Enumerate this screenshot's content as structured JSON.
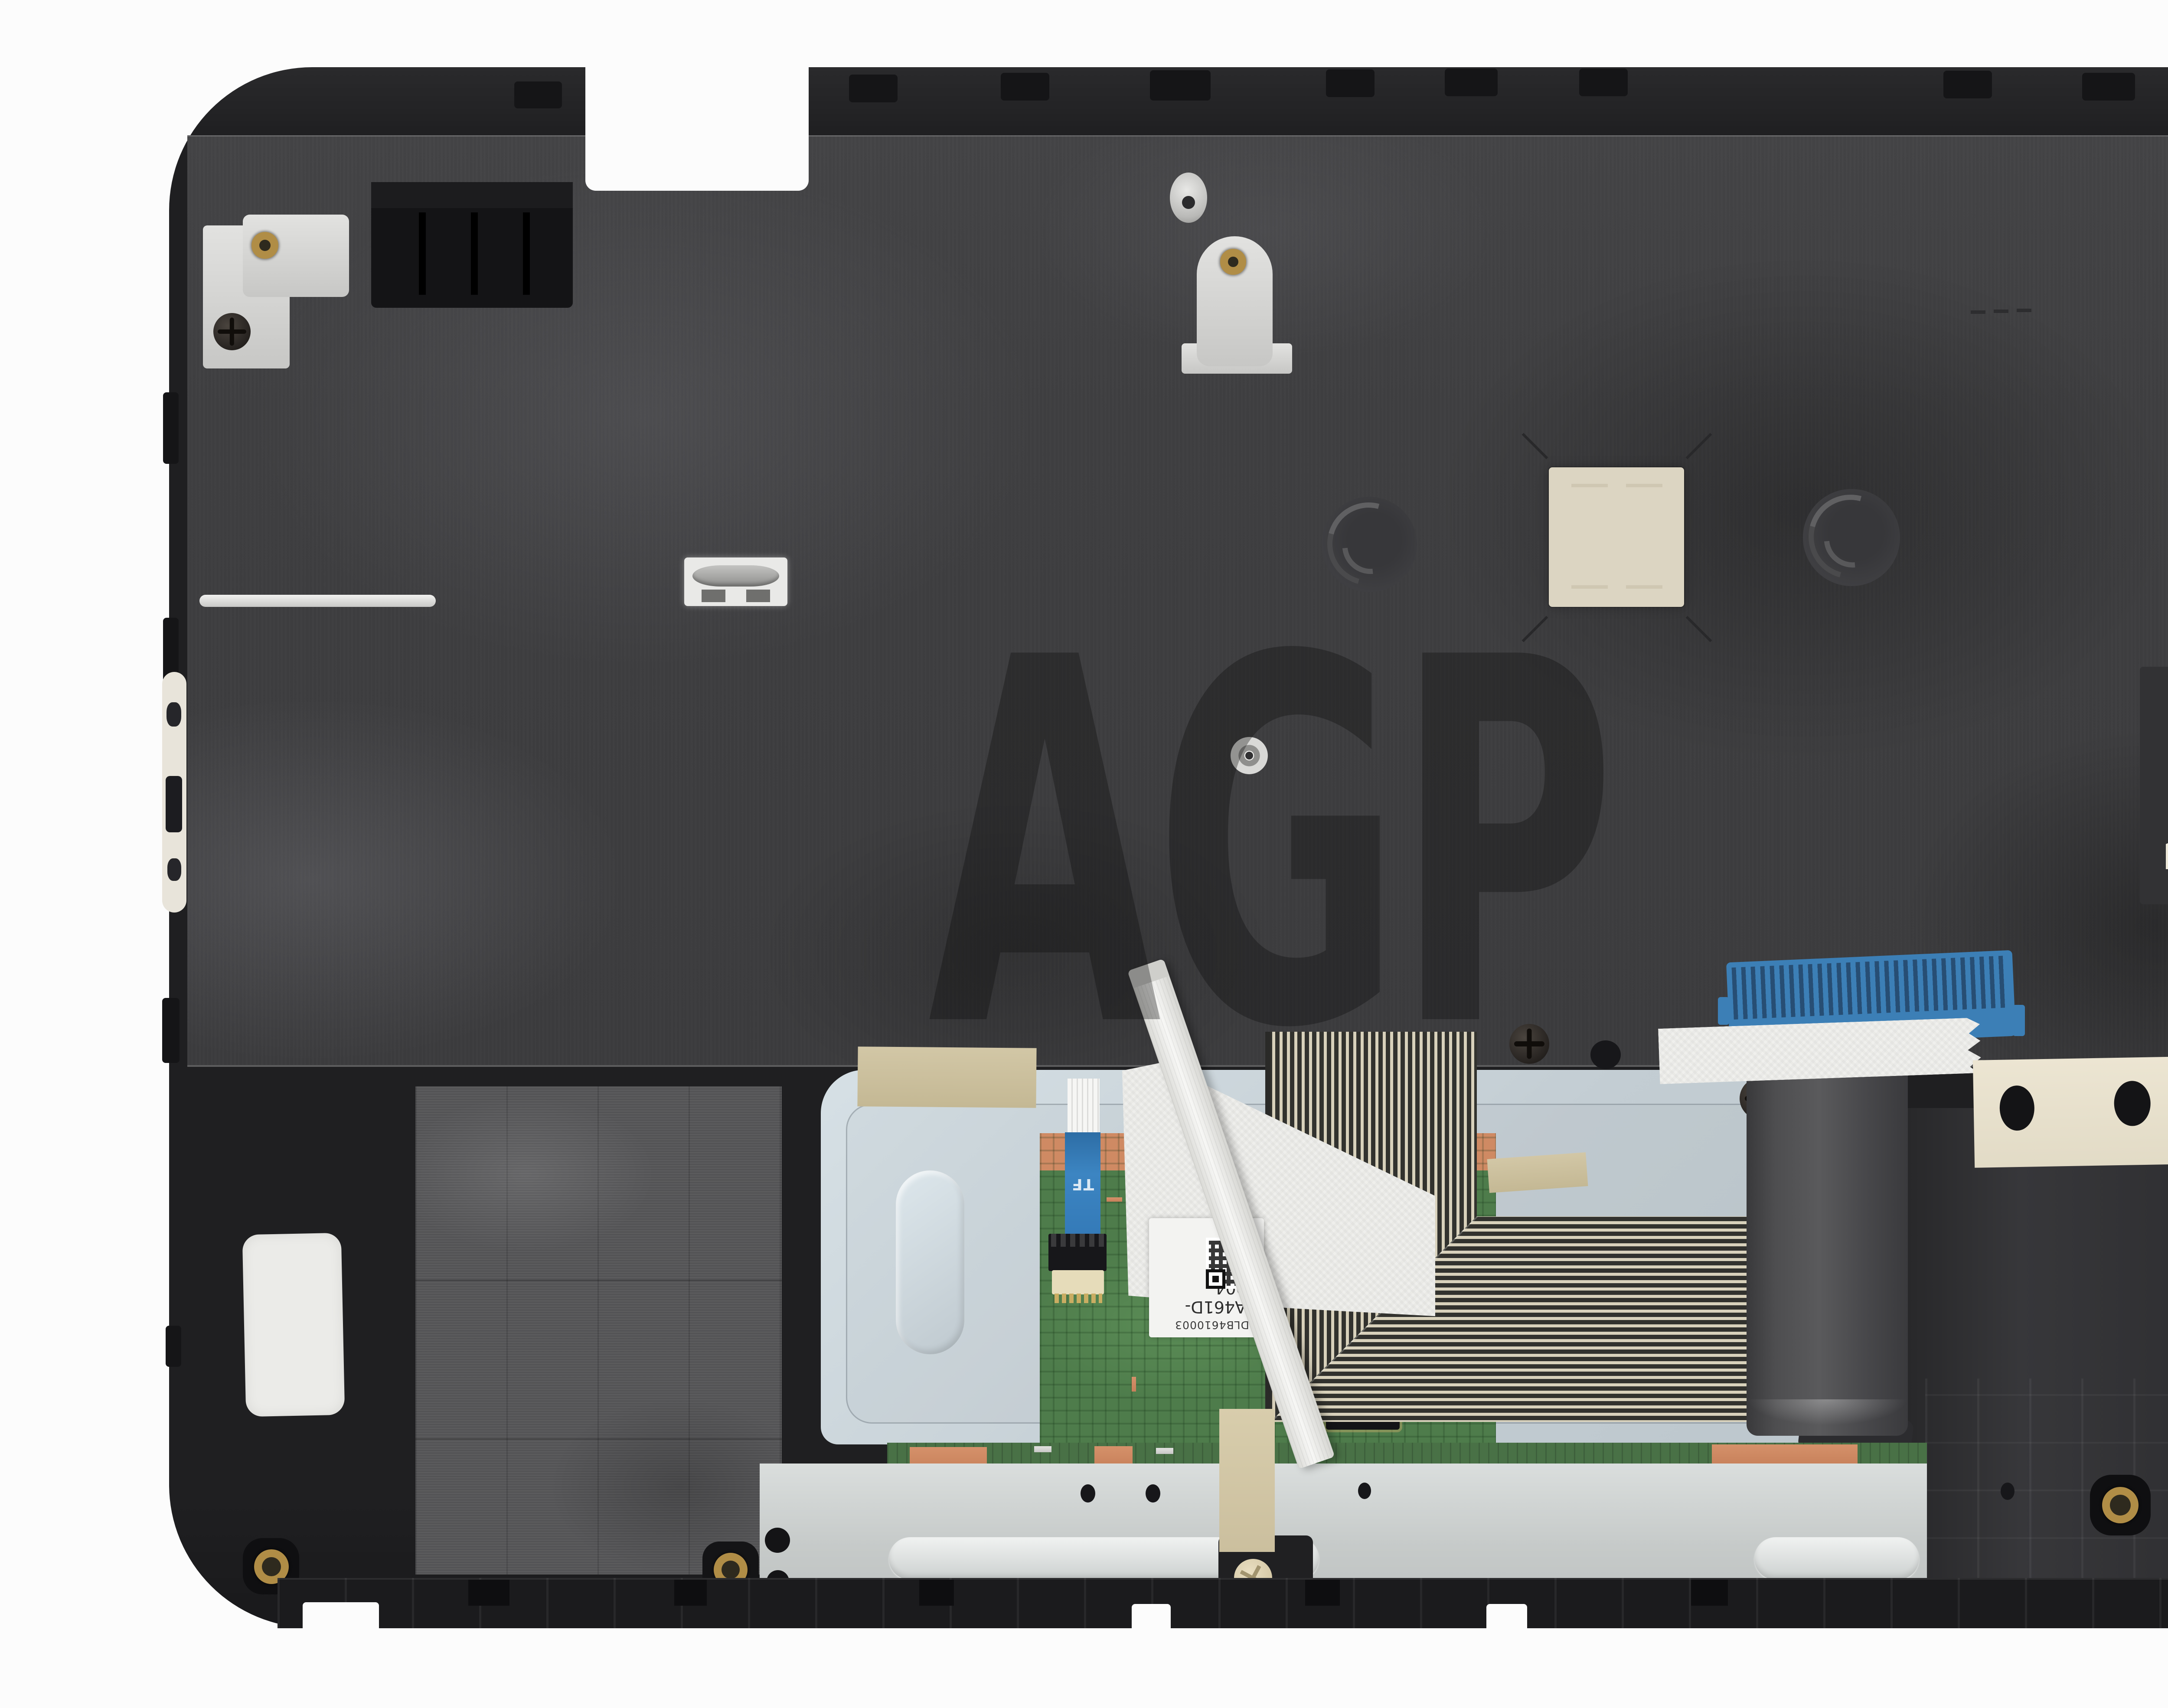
{
  "photo": {
    "subject": "laptop-palmrest-assembly-bottom-view",
    "watermark_text": "AGP",
    "touchpad_label": {
      "line1": "ADLB4610003",
      "line2": "SA461D-1004"
    },
    "ffc_marking": "TF",
    "palette": {
      "background": "#fcfcfc",
      "chassis_plastic": "#202022",
      "keyboard_backplate": "#3e3e40",
      "touchpad_bracket_metal": "#c9d3d9",
      "touchpad_pcb_green": "#4e7c4b",
      "copper_pad": "#cf8a63",
      "flex_trace_cream": "#d8d1bb",
      "flex_base_black": "#32322e",
      "ffc_blue": "#3c7fb6",
      "tape_white": "#f0f0ed",
      "tape_tan": "#cbbf9e",
      "bottom_bracket_silver": "#d0d4d3",
      "brass_insert": "#b08d46",
      "felt_pad": "#545456"
    }
  }
}
